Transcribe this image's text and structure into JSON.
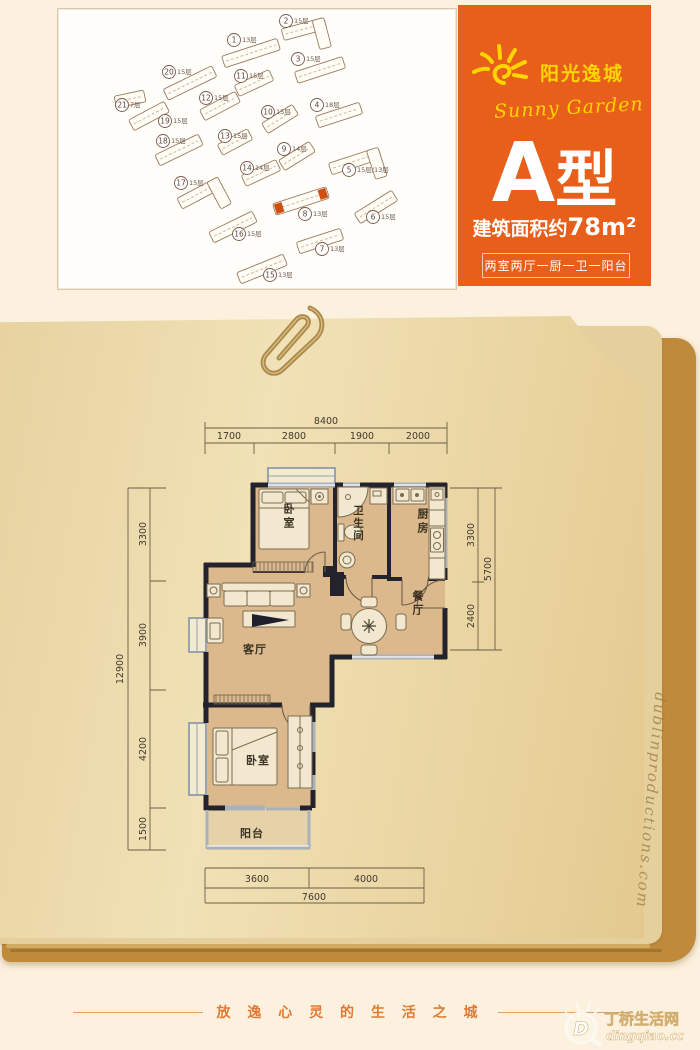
{
  "brand": {
    "name_cn": "阳光逸城",
    "name_en": "Sunny Garden",
    "unit_type_letter": "A",
    "unit_type_suffix": "型",
    "area_prefix": "建筑面积约",
    "area_value": "78m²",
    "layout_desc": "两室两厅一厨一卫一阳台",
    "panel_color": "#e75f1b",
    "accent_color": "#ffd400"
  },
  "siteplan": {
    "highlight_color": "#cf4e12",
    "buildings": [
      {
        "no": "1",
        "floors": "13层",
        "x": 193,
        "y": 44,
        "r": -18,
        "len": 58,
        "lx": 176,
        "ly": 31,
        "hl": false,
        "l": false
      },
      {
        "no": "2",
        "floors": "15层",
        "x": 246,
        "y": 20,
        "r": -15,
        "len": 44,
        "lx": 228,
        "ly": 12,
        "hl": false,
        "l": true
      },
      {
        "no": "3",
        "floors": "15层",
        "x": 262,
        "y": 61,
        "r": -18,
        "len": 50,
        "lx": 240,
        "ly": 50,
        "hl": false,
        "l": false
      },
      {
        "no": "4",
        "floors": "18层",
        "x": 281,
        "y": 106,
        "r": -18,
        "len": 46,
        "lx": 259,
        "ly": 96,
        "hl": false,
        "l": false
      },
      {
        "no": "5",
        "floors": "15层/13层",
        "x": 297,
        "y": 152,
        "r": -18,
        "len": 52,
        "lx": 291,
        "ly": 161,
        "hl": false,
        "l": true
      },
      {
        "no": "6",
        "floors": "15层",
        "x": 318,
        "y": 198,
        "r": -32,
        "len": 44,
        "lx": 315,
        "ly": 208,
        "hl": false,
        "l": false
      },
      {
        "no": "7",
        "floors": "13层",
        "x": 262,
        "y": 232,
        "r": -18,
        "len": 46,
        "lx": 264,
        "ly": 240,
        "hl": false,
        "l": false
      },
      {
        "no": "8",
        "floors": "13层",
        "x": 243,
        "y": 192,
        "r": -18,
        "len": 56,
        "lx": 247,
        "ly": 205,
        "hl": true,
        "l": false
      },
      {
        "no": "9",
        "floors": "14层",
        "x": 239,
        "y": 147,
        "r": -32,
        "len": 36,
        "lx": 226,
        "ly": 140,
        "hl": false,
        "l": false
      },
      {
        "no": "10",
        "floors": "15层",
        "x": 222,
        "y": 110,
        "r": -32,
        "len": 36,
        "lx": 210,
        "ly": 103,
        "hl": false,
        "l": false
      },
      {
        "no": "11",
        "floors": "15层",
        "x": 196,
        "y": 74,
        "r": -25,
        "len": 38,
        "lx": 183,
        "ly": 67,
        "hl": false,
        "l": false
      },
      {
        "no": "12",
        "floors": "15层",
        "x": 162,
        "y": 97,
        "r": -28,
        "len": 40,
        "lx": 148,
        "ly": 89,
        "hl": false,
        "l": false
      },
      {
        "no": "13",
        "floors": "15层",
        "x": 177,
        "y": 133,
        "r": -28,
        "len": 34,
        "lx": 167,
        "ly": 127,
        "hl": false,
        "l": false
      },
      {
        "no": "14",
        "floors": "14层",
        "x": 203,
        "y": 164,
        "r": -25,
        "len": 38,
        "lx": 189,
        "ly": 159,
        "hl": false,
        "l": false
      },
      {
        "no": "15",
        "floors": "13层",
        "x": 204,
        "y": 260,
        "r": -22,
        "len": 50,
        "lx": 212,
        "ly": 266,
        "hl": false,
        "l": false
      },
      {
        "no": "16",
        "floors": "15层",
        "x": 175,
        "y": 218,
        "r": -26,
        "len": 48,
        "lx": 181,
        "ly": 225,
        "hl": false,
        "l": false
      },
      {
        "no": "17",
        "floors": "15层",
        "x": 142,
        "y": 184,
        "r": -28,
        "len": 46,
        "lx": 123,
        "ly": 174,
        "hl": false,
        "l": true
      },
      {
        "no": "18",
        "floors": "15层",
        "x": 121,
        "y": 141,
        "r": -26,
        "len": 48,
        "lx": 105,
        "ly": 132,
        "hl": false,
        "l": false
      },
      {
        "no": "19",
        "floors": "15层",
        "x": 91,
        "y": 107,
        "r": -28,
        "len": 40,
        "lx": 107,
        "ly": 112,
        "hl": false,
        "l": false
      },
      {
        "no": "20",
        "floors": "15层",
        "x": 132,
        "y": 74,
        "r": -26,
        "len": 54,
        "lx": 111,
        "ly": 63,
        "hl": false,
        "l": false
      },
      {
        "no": "21",
        "floors": "7层",
        "x": 72,
        "y": 90,
        "r": -12,
        "len": 30,
        "lx": 64,
        "ly": 96,
        "hl": false,
        "l": false
      }
    ]
  },
  "floorplan": {
    "rooms": {
      "bedroom_top": "卧室",
      "bathroom": "卫生间",
      "kitchen": "厨房",
      "dining": "餐厅",
      "living": "客厅",
      "bedroom_bottom": "卧室",
      "balcony": "阳台"
    },
    "dims": {
      "top_total": "8400",
      "top": [
        "1700",
        "2800",
        "1900",
        "2000"
      ],
      "left_total": "12900",
      "left": [
        "3300",
        "3900",
        "4200",
        "1500"
      ],
      "right": [
        "3300",
        "2400"
      ],
      "right_total": "5700",
      "bottom": [
        "3600",
        "4000"
      ],
      "bottom_total": "7600"
    }
  },
  "footer": {
    "slogan": "放 逸 心 灵 的 生 活 之 城"
  },
  "watermarks": {
    "handwriting": "dublinproductions.com",
    "site_cn": "丁桥生活网",
    "site_en": "dingqiao.cc"
  }
}
